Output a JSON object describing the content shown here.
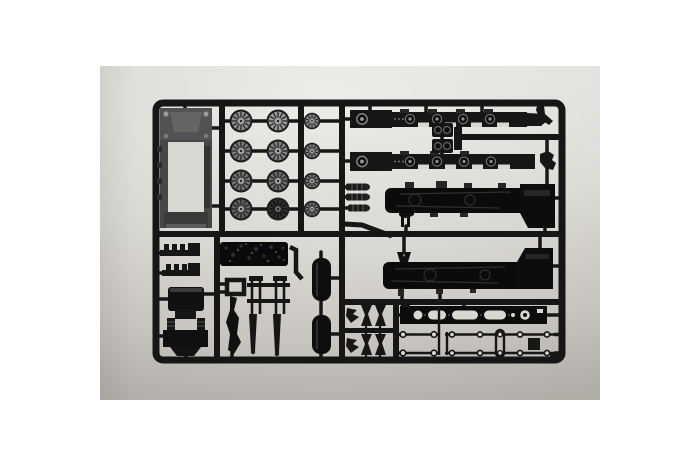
{
  "scene": {
    "type": "photograph",
    "subject": "Black injection-molded plastic model kit sprue with steam locomotive parts, photographed on a light gray backdrop",
    "aria_label": "Photograph of a black model-kit sprue holding steam locomotive parts",
    "colors": {
      "canvas": "#ffffff",
      "backdrop_top": "#edebe7",
      "backdrop_mid": "#dad8d3",
      "backdrop_bottom": "#b1aea8",
      "plastic": "#161616",
      "plastic_soft": "#262626",
      "gray_part": "#474747",
      "gray_light": "#9a9a9a",
      "hole": "#d9d7d2"
    },
    "parts": [
      "tender-chassis-frame",
      "large-driver-wheels-x8",
      "small-driver-wheels-x4",
      "locomotive-side-frame-x2",
      "cylinder-blocks-x2",
      "boiler-half-x2",
      "leaf-spring-pumps-x3",
      "coal-load",
      "running-steps-x2",
      "cab-roof",
      "cab-window-frame",
      "pilot-beam",
      "connecting-rod",
      "valve-gear-rods",
      "air-tank-x2",
      "running-board",
      "handrail-rods",
      "valve-links-x4"
    ]
  }
}
